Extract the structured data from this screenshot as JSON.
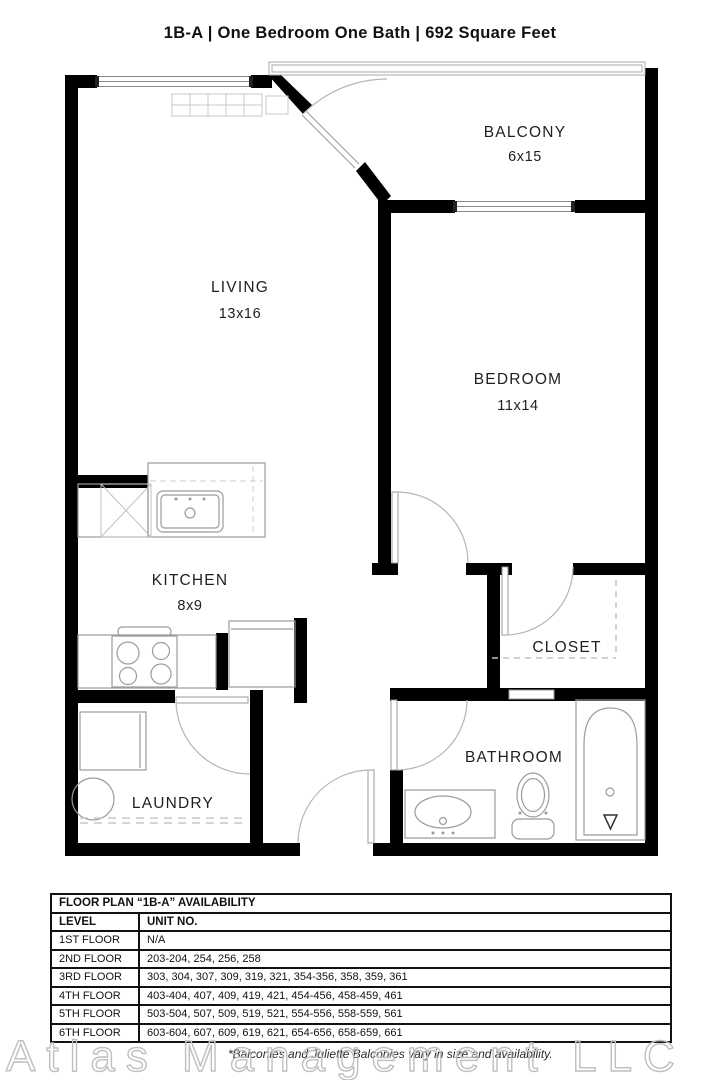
{
  "title": "1B-A  |  One Bedroom One Bath  |  692 Square Feet",
  "colors": {
    "wall": "#000000",
    "fixture_line": "#9b9b9b",
    "dashed_line": "#c8c8c8",
    "text": "#1f1f1f",
    "watermark_gray": "#bfbfbf"
  },
  "floorplan": {
    "rooms": {
      "balcony": {
        "name": "BALCONY",
        "dims": "6x15"
      },
      "living": {
        "name": "LIVING",
        "dims": "13x16"
      },
      "bedroom": {
        "name": "BEDROOM",
        "dims": "11x14"
      },
      "kitchen": {
        "name": "KITCHEN",
        "dims": "8x9"
      },
      "closet": {
        "name": "CLOSET"
      },
      "laundry": {
        "name": "LAUNDRY"
      },
      "bathroom": {
        "name": "BATHROOM"
      }
    }
  },
  "availability_table": {
    "title": "FLOOR PLAN “1B-A” AVAILABILITY",
    "columns": [
      "LEVEL",
      "UNIT NO."
    ],
    "rows": [
      {
        "level": "1ST FLOOR",
        "units": "N/A"
      },
      {
        "level": "2ND FLOOR",
        "units": "203-204, 254, 256, 258"
      },
      {
        "level": "3RD FLOOR",
        "units": "303, 304, 307, 309, 319, 321, 354-356, 358, 359, 361"
      },
      {
        "level": "4TH FLOOR",
        "units": "403-404, 407, 409, 419, 421, 454-456, 458-459, 461"
      },
      {
        "level": "5TH FLOOR",
        "units": "503-504, 507, 509, 519, 521, 554-556, 558-559, 561"
      },
      {
        "level": "6TH FLOOR",
        "units": "603-604, 607, 609, 619, 621, 654-656, 658-659, 661"
      }
    ]
  },
  "footnote": "*Balconies and Juliette Balconies vary in size and availability.",
  "watermark": "Atlas Management LLC"
}
